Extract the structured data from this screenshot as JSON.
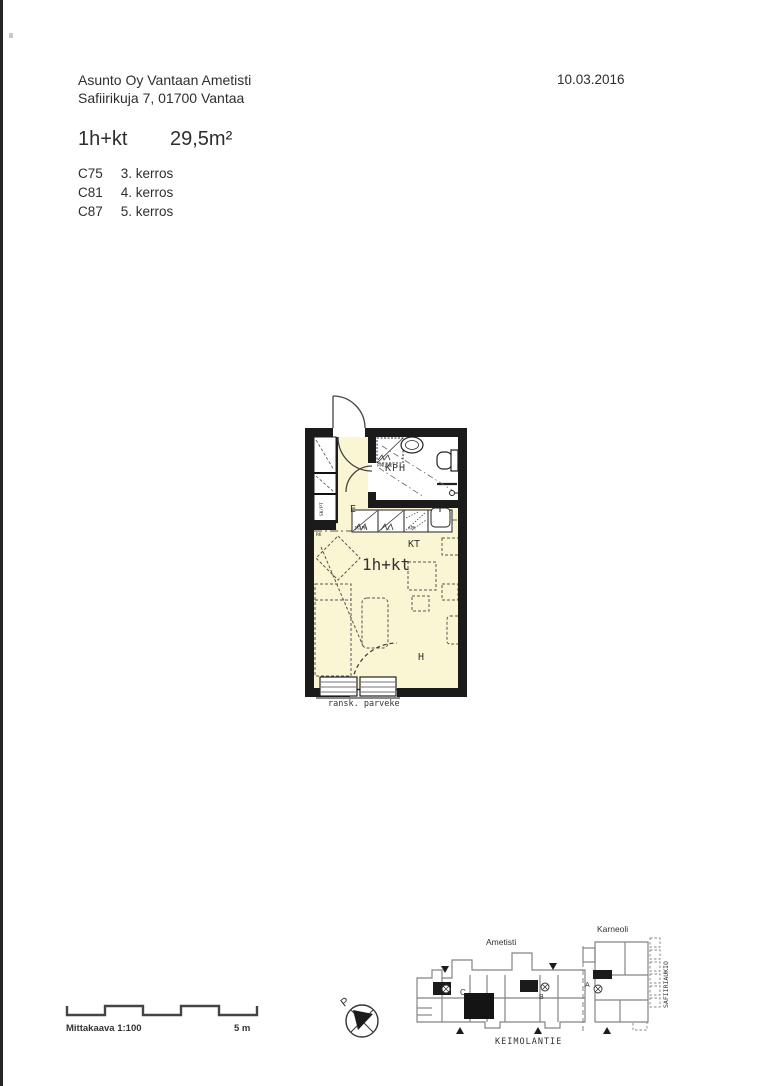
{
  "header": {
    "company": "Asunto Oy Vantaan Ametisti",
    "address": "Safiirikuja 7, 01700 Vantaa",
    "date": "10.03.2016",
    "apartment_type": "1h+kt",
    "area": "29,5m²",
    "units": [
      {
        "code": "C75",
        "floor": "3. kerros"
      },
      {
        "code": "C81",
        "floor": "4. kerros"
      },
      {
        "code": "C87",
        "floor": "5. kerros"
      }
    ]
  },
  "plan": {
    "room_labels": {
      "hall": "E",
      "bathroom": "KPH",
      "kitchen": "KT",
      "room": "H",
      "type": "1h+kt"
    },
    "fixture_labels": {
      "washer": "PPK/KK",
      "fridge": "JK/PK",
      "stove": "L",
      "dishwasher": "APK",
      "closet": "SK/PT",
      "electric": "RK"
    },
    "balcony_label": "ransk. parveke"
  },
  "footer": {
    "scale_label": "Mittakaava 1:100",
    "scale_end": "5 m",
    "north_letter": "P",
    "siteplan": {
      "building_left": "Ametisti",
      "building_right": "Karneoli",
      "street_bottom": "KEIMOLANTIE",
      "street_right": "SAFIIRIAUKIO",
      "stair_a": "A",
      "stair_b": "B",
      "stair_c": "C"
    }
  },
  "colors": {
    "wall": "#1b1b1b",
    "floor_yellow": "#faf6d4",
    "line": "#3a3a3a",
    "site_gray": "#848484"
  }
}
